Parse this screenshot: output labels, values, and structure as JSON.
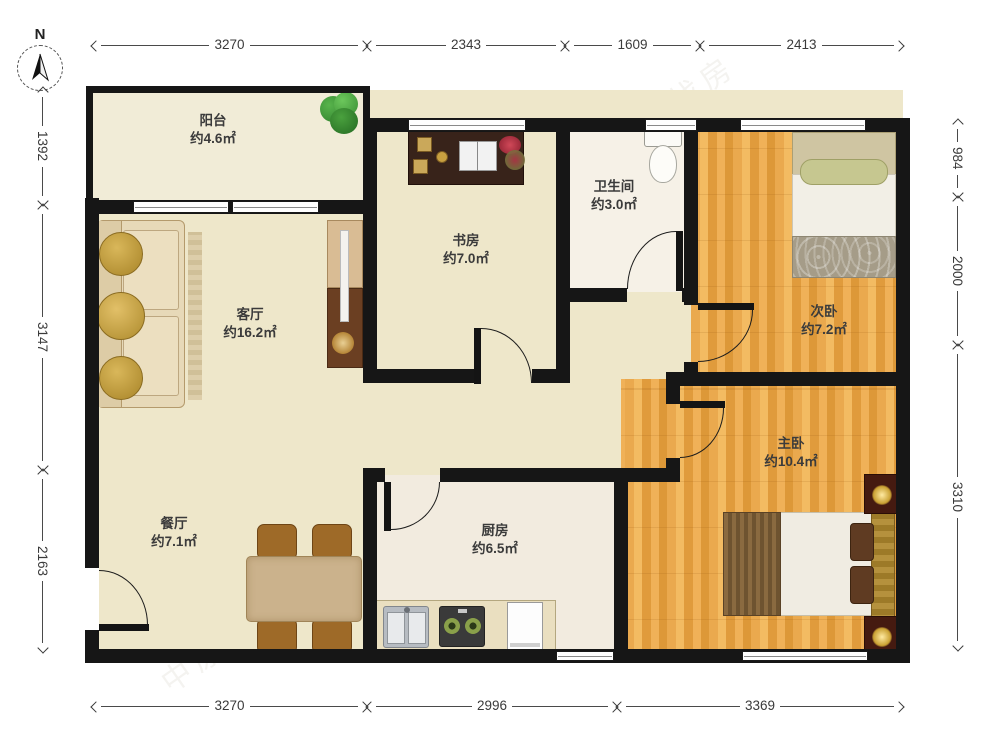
{
  "compass": {
    "north_label": "N"
  },
  "rooms": {
    "balcony": {
      "name": "阳台",
      "area": "约4.6㎡"
    },
    "study": {
      "name": "书房",
      "area": "约7.0㎡"
    },
    "bathroom": {
      "name": "卫生间",
      "area": "约3.0㎡"
    },
    "second_bedroom": {
      "name": "次卧",
      "area": "约7.2㎡"
    },
    "living_room": {
      "name": "客厅",
      "area": "约16.2㎡"
    },
    "master_bedroom": {
      "name": "主卧",
      "area": "约10.4㎡"
    },
    "dining_room": {
      "name": "餐厅",
      "area": "约7.1㎡"
    },
    "kitchen": {
      "name": "厨房",
      "area": "约6.5㎡"
    }
  },
  "dimensions": {
    "top": [
      "3270",
      "2343",
      "1609",
      "2413"
    ],
    "bottom": [
      "3270",
      "2996",
      "3369"
    ],
    "left": [
      "1392",
      "3147",
      "2163"
    ],
    "right": [
      "984",
      "2000",
      "3310"
    ]
  },
  "watermark": {
    "text": "中原找房"
  },
  "colors": {
    "wall": "#161616",
    "floor_cream": "#eee7ca",
    "floor_wood": "#eaa94e",
    "dimension_text": "#3a3a3a"
  }
}
